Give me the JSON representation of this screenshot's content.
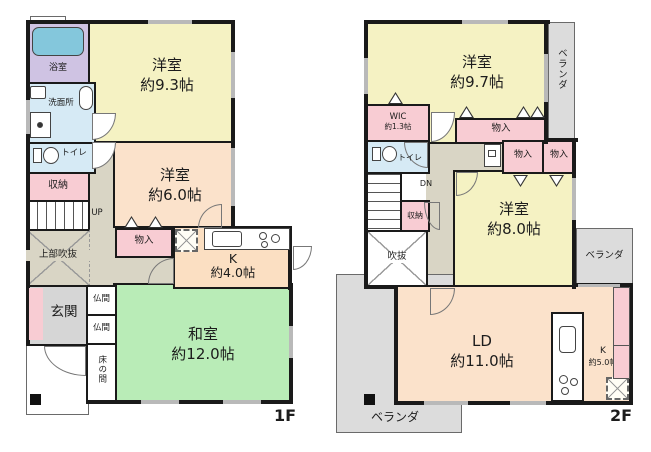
{
  "palette": {
    "wall": "#1a1a1a",
    "western_room_yellow": "#f5f2c3",
    "peach_room": "#fbe2cb",
    "kitchen_peach": "#fbdfc2",
    "japanese_room_green": "#b9ecb7",
    "closet_pink": "#f8ccd3",
    "wet_area_blue": "#d6eaf5",
    "bath_purple": "#cfc3e3",
    "bathtub_blue": "#84c7dc",
    "hall_beige": "#d9d5c5",
    "entrance_gray": "#d6d6d6",
    "veranda_gray": "#dcdcdc"
  },
  "floor1": {
    "label": "1F",
    "rooms": {
      "bath": "浴室",
      "washroom": "洗面所",
      "toilet": "トイレ",
      "storage": "収納",
      "stairs_up": "UP",
      "open_above": "上部吹抜",
      "closet": "物入",
      "entrance": "玄関",
      "altar1": "仏間",
      "altar2": "仏間",
      "alcove": "床の間",
      "japanese_room": {
        "name": "和室",
        "size": "約12.0帖"
      },
      "western_room_93": {
        "name": "洋室",
        "size": "約9.3帖"
      },
      "western_room_60": {
        "name": "洋室",
        "size": "約6.0帖"
      },
      "kitchen": {
        "name": "K",
        "size": "約4.0帖"
      }
    }
  },
  "floor2": {
    "label": "2F",
    "rooms": {
      "western_room_97": {
        "name": "洋室",
        "size": "約9.7帖"
      },
      "veranda_top": "ベランダ",
      "wic": {
        "name": "WIC",
        "size": "約1.3帖"
      },
      "closet_97": "物入",
      "toilet": "トイレ",
      "closet_a": "物入",
      "closet_b": "物入",
      "stairs_down": "DN",
      "storage": "収納",
      "void": "吹抜",
      "western_room_80": {
        "name": "洋室",
        "size": "約8.0帖"
      },
      "veranda_mid": "ベランダ",
      "living_dining": {
        "name": "LD",
        "size": "約11.0帖"
      },
      "kitchen": {
        "name": "K",
        "size": "約5.0帖"
      },
      "veranda_bottom": "ベランダ"
    }
  }
}
